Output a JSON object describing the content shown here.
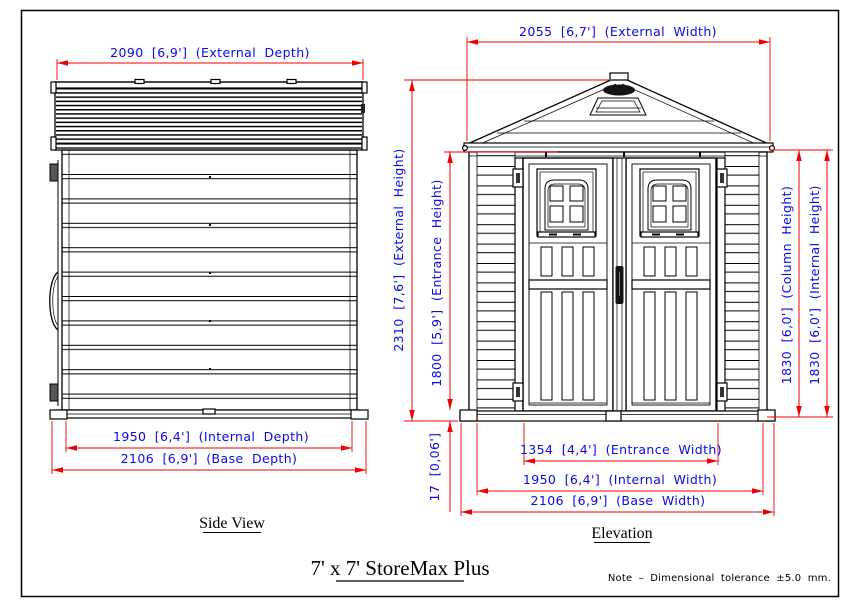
{
  "drawing": {
    "title": "7' x 7' StoreMax Plus",
    "note": "Note  –  Dimensional  tolerance  ±5.0 mm.",
    "colors": {
      "dimension_lines": "#ff0000",
      "dimension_text": "#0909f0",
      "line_art": "#000000"
    },
    "side_view": {
      "label": "Side View",
      "external_depth": "2090 [6,9']  (External Depth)",
      "internal_depth": "1950 [6,4']  (Internal Depth)",
      "base_depth": "2106 [6,9']  (Base Depth)"
    },
    "elevation": {
      "label": "Elevation",
      "external_width": "2055 [6,7']  (External Width)",
      "external_height": "2310 [7,6']  (External Height)",
      "entrance_height": "1800 [5,9']  (Entrance Height)",
      "base_height": "17 [0,06']",
      "column_height": "1830 [6,0']  (Column Height)",
      "internal_height": "1830 [6,0']  (Internal Height)",
      "entrance_width": "1354 [4,4']  (Entrance Width)",
      "internal_width": "1950 [6,4']  (Internal Width)",
      "base_width": "2106 [6,9']  (Base Width)"
    }
  }
}
